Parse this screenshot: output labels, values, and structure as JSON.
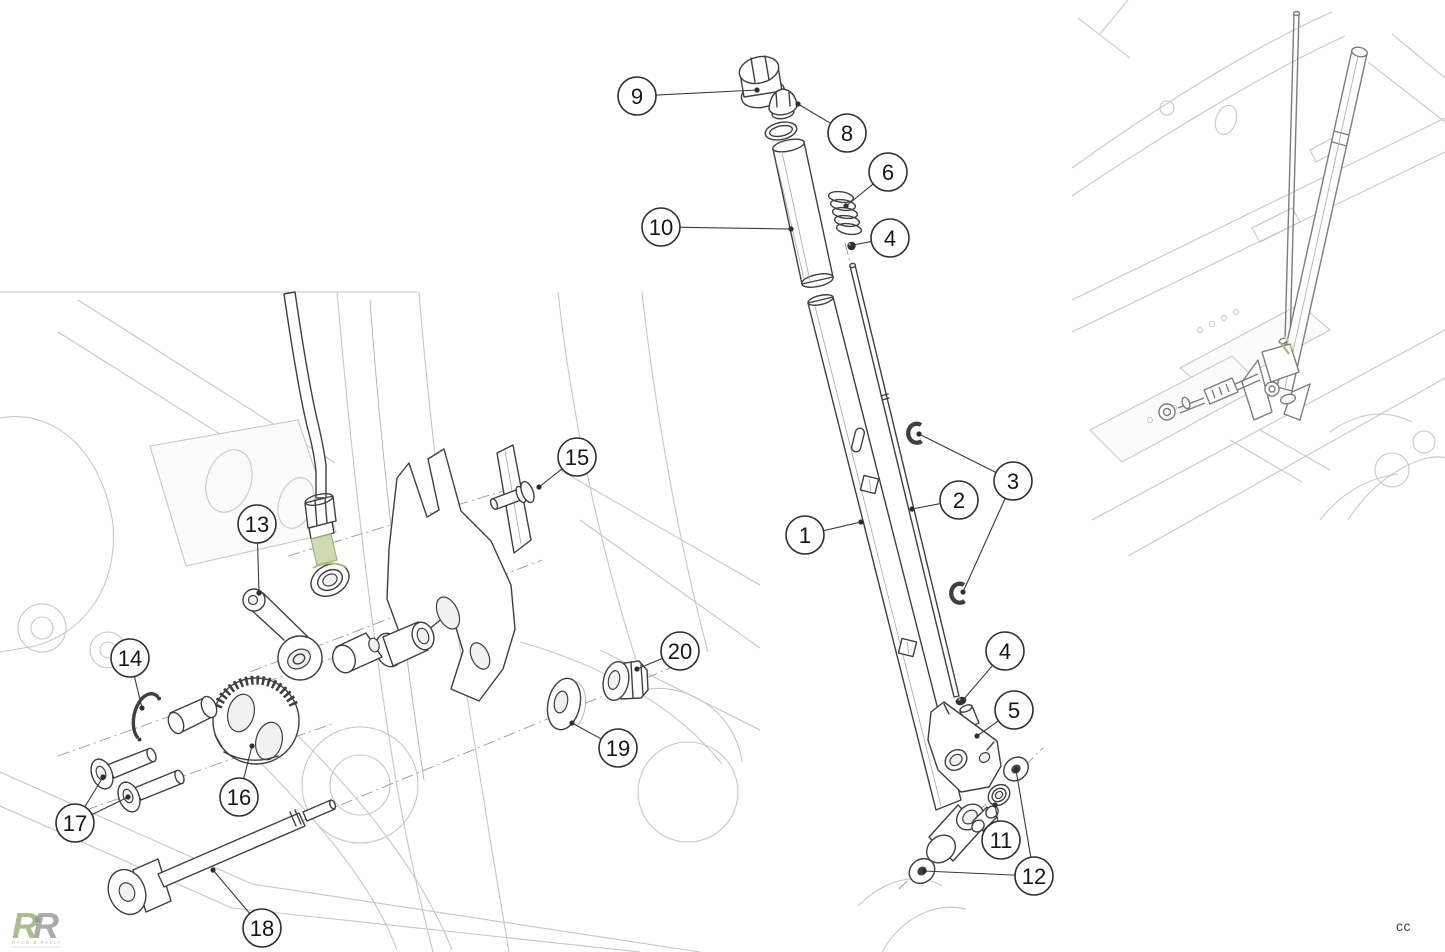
{
  "page": {
    "background": "#ffffff"
  },
  "colors": {
    "dark": "#3f3f3f",
    "mid": "#8a8a8a",
    "light": "#c7c7c7",
    "xlight": "#e4e4e4",
    "green": "#8fae6d",
    "greenLight": "#cfdcb2",
    "greenStroke": "#66813f",
    "co": "#2f2f2f",
    "leader": "#3a3a3a",
    "ink": "#161616"
  },
  "branding": {
    "monogram_left": "R",
    "monogram_amp": "&",
    "monogram_right": "R",
    "subtext": "RACE & RALLY"
  },
  "footer": {
    "credit": "cc"
  },
  "diagram": {
    "type": "exploded-parts-diagram",
    "callouts": [
      {
        "part": "9",
        "cx": 637,
        "cy": 96,
        "r": 19,
        "targets": [
          [
            757,
            90
          ]
        ]
      },
      {
        "part": "8",
        "cx": 847,
        "cy": 133,
        "r": 19,
        "targets": [
          [
            798,
            104
          ]
        ]
      },
      {
        "part": "6",
        "cx": 888,
        "cy": 172,
        "r": 19,
        "targets": [
          [
            846,
            206
          ]
        ]
      },
      {
        "part": "10",
        "cx": 661,
        "cy": 227,
        "r": 19,
        "targets": [
          [
            791,
            229
          ]
        ]
      },
      {
        "part": "4",
        "cx": 890,
        "cy": 238,
        "r": 19,
        "targets": [
          [
            853,
            245
          ]
        ]
      },
      {
        "part": "15",
        "cx": 577,
        "cy": 457,
        "r": 19,
        "targets": [
          [
            539,
            487
          ]
        ]
      },
      {
        "part": "3",
        "cx": 1013,
        "cy": 481,
        "r": 19,
        "targets": [
          [
            919,
            434
          ],
          [
            963,
            592
          ]
        ]
      },
      {
        "part": "2",
        "cx": 959,
        "cy": 500,
        "r": 19,
        "targets": [
          [
            912,
            509
          ]
        ]
      },
      {
        "part": "1",
        "cx": 805,
        "cy": 535,
        "r": 19,
        "targets": [
          [
            861,
            522
          ]
        ]
      },
      {
        "part": "13",
        "cx": 257,
        "cy": 524,
        "r": 19,
        "targets": [
          [
            259,
            593
          ]
        ]
      },
      {
        "part": "14",
        "cx": 130,
        "cy": 658,
        "r": 19,
        "targets": [
          [
            142,
            708
          ]
        ]
      },
      {
        "part": "20",
        "cx": 680,
        "cy": 651,
        "r": 19,
        "targets": [
          [
            637,
            669
          ]
        ]
      },
      {
        "part": "4",
        "cx": 1005,
        "cy": 651,
        "r": 19,
        "targets": [
          [
            963,
            700
          ]
        ]
      },
      {
        "part": "5",
        "cx": 1014,
        "cy": 710,
        "r": 19,
        "targets": [
          [
            977,
            736
          ]
        ]
      },
      {
        "part": "19",
        "cx": 618,
        "cy": 748,
        "r": 19,
        "targets": [
          [
            572,
            723
          ]
        ]
      },
      {
        "part": "16",
        "cx": 239,
        "cy": 797,
        "r": 19,
        "targets": [
          [
            252,
            746
          ]
        ]
      },
      {
        "part": "17",
        "cx": 75,
        "cy": 823,
        "r": 19,
        "targets": [
          [
            103,
            777
          ],
          [
            128,
            797
          ]
        ]
      },
      {
        "part": "11",
        "cx": 1001,
        "cy": 840,
        "r": 19,
        "targets": [
          [
            995,
            805
          ]
        ]
      },
      {
        "part": "12",
        "cx": 1034,
        "cy": 876,
        "r": 19,
        "targets": [
          [
            1016,
            770
          ],
          [
            924,
            871
          ]
        ]
      },
      {
        "part": "18",
        "cx": 262,
        "cy": 928,
        "r": 19,
        "targets": [
          [
            213,
            870
          ]
        ]
      }
    ]
  }
}
